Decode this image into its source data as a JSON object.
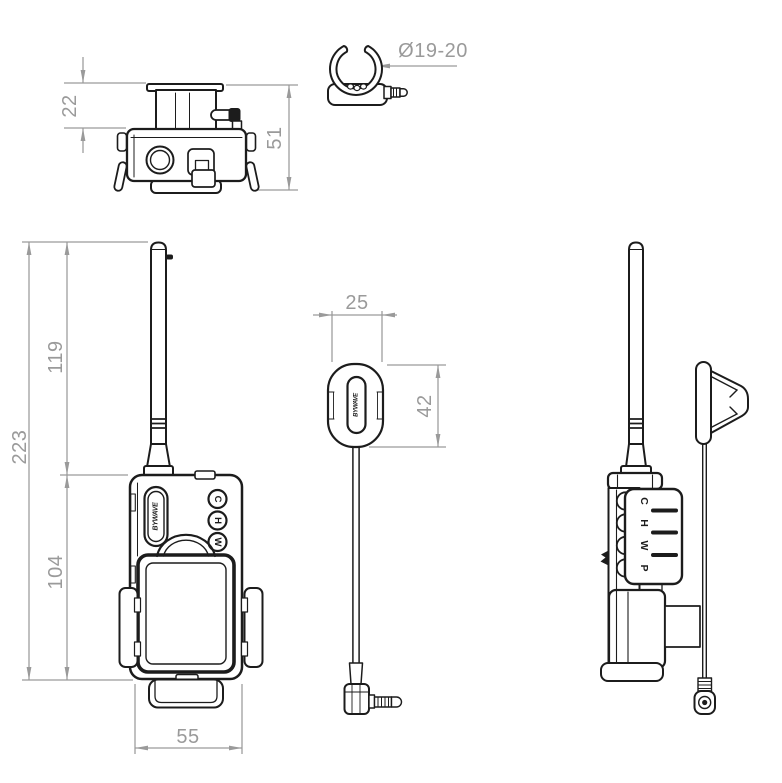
{
  "drawing": {
    "brand": "BYWAVE",
    "colors": {
      "ink": "#1c1c1c",
      "dim": "#9a9a9a",
      "background": "#ffffff"
    },
    "dimensions": {
      "top_view_upper_height": "22",
      "top_view_total_height": "51",
      "clip_inner_diameter": "Ø19-20",
      "front_total_height": "223",
      "front_antenna_height": "119",
      "front_body_height": "104",
      "front_body_width": "55",
      "remote_width": "25",
      "remote_height": "42"
    },
    "front_buttons": [
      {
        "label": "C"
      },
      {
        "label": "H"
      },
      {
        "label": "W"
      }
    ],
    "side_buttons": [
      {
        "label": "C"
      },
      {
        "label": "H"
      },
      {
        "label": "W"
      },
      {
        "label": "P"
      }
    ]
  }
}
